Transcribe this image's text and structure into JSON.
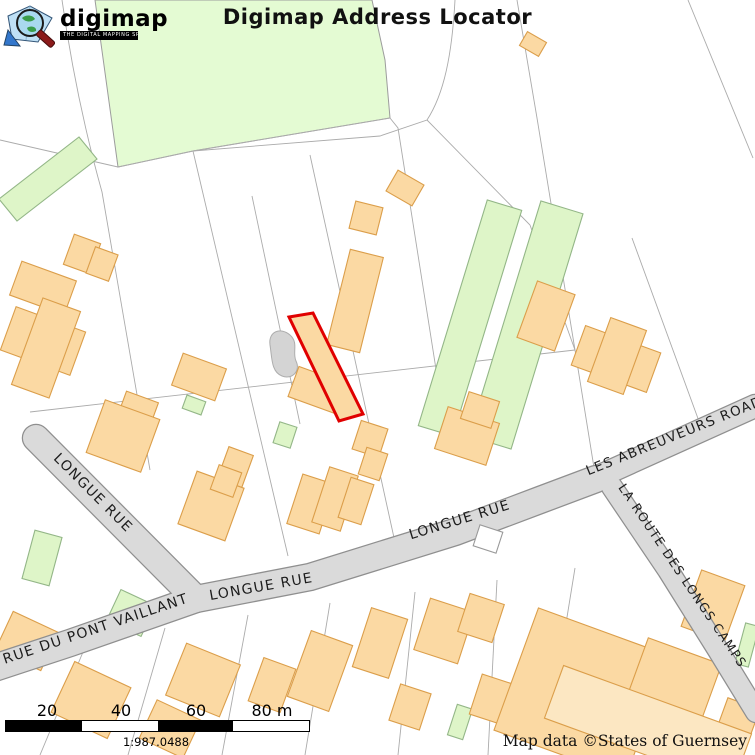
{
  "header": {
    "title": "Digimap Address Locator",
    "logo": {
      "brand": "digimap",
      "tagline": "THE DIGITAL MAPPING SPECIALISTS"
    }
  },
  "map": {
    "road_labels": [
      {
        "id": "longue-rue-west",
        "text": "LONGUE RUE"
      },
      {
        "id": "rue-du-pont-vaillant",
        "text": "RUE DU PONT VAILLANT"
      },
      {
        "id": "longue-rue-south",
        "text": "LONGUE RUE"
      },
      {
        "id": "longue-rue-east",
        "text": "LONGUE RUE"
      },
      {
        "id": "les-abreuveurs-road",
        "text": "LES ABREUVEURS ROAD"
      },
      {
        "id": "la-route-des-longs-camps",
        "text": "LA ROUTE DES LONGS CAMPS"
      }
    ],
    "colors": {
      "background": "#ffffff",
      "field_green": "#e4fbd3",
      "greenhouse_green": "#def5c8",
      "greenhouse_stroke": "#93b687",
      "building_orange": "#fbd9a3",
      "building_orange_light": "#fce7c2",
      "building_stroke": "#db9e4a",
      "road_fill": "#dadada",
      "road_casing": "#8f8f8f",
      "parcel_line": "#ababab",
      "pond_gray": "#d4d4d4",
      "highlight_red": "#e00000"
    }
  },
  "scale_bar": {
    "ticks": [
      "20",
      "40",
      "60",
      "80 m"
    ],
    "ratio": "1:987.0488"
  },
  "attribution": "Map data ©States of Guernsey"
}
